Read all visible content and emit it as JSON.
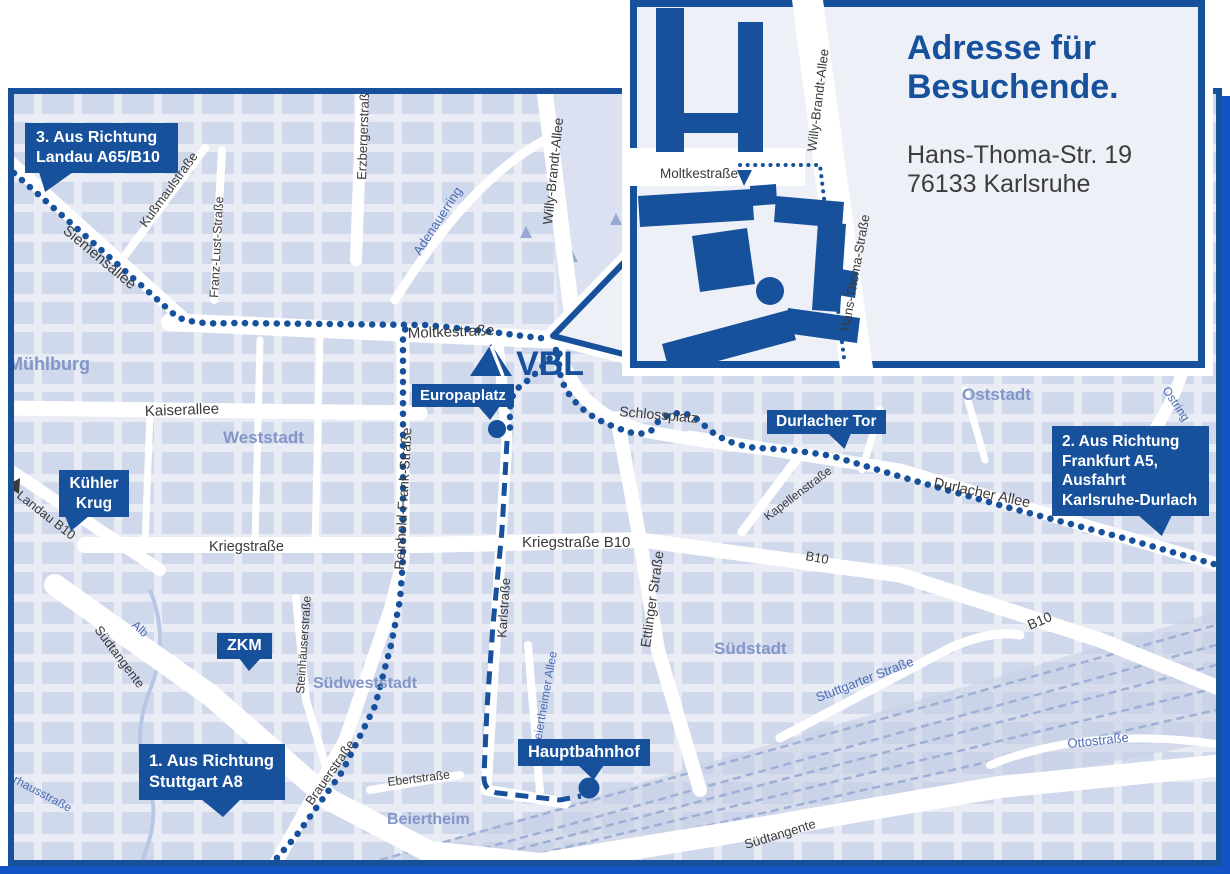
{
  "inset": {
    "title": [
      "Adresse für",
      "Besuchende."
    ],
    "address": [
      "Hans-Thoma-Str. 19",
      "76133 Karlsruhe"
    ],
    "streets": {
      "moltkestrasse": "Moltkestraße",
      "willy_brandt_allee": "Willy-Brandt-Allee",
      "hans_thoma_strasse": "Hans-Thoma-Straße"
    }
  },
  "logo": {
    "text": "VBL"
  },
  "callouts": {
    "route3": {
      "lines": [
        "3. Aus Richtung",
        "Landau A65/B10"
      ]
    },
    "route2": {
      "lines": [
        "2. Aus Richtung",
        "Frankfurt A5,",
        "Ausfahrt",
        "Karlsruhe-Durlach"
      ]
    },
    "route1": {
      "lines": [
        "1. Aus Richtung",
        "Stuttgart A8"
      ]
    },
    "kuehler_krug": {
      "lines": [
        "Kühler",
        "Krug"
      ]
    },
    "zkm": {
      "lines": [
        "ZKM"
      ]
    },
    "europaplatz": {
      "lines": [
        "Europaplatz"
      ]
    },
    "durlacher_tor": {
      "lines": [
        "Durlacher Tor"
      ]
    },
    "hauptbahnhof": {
      "lines": [
        "Hauptbahnhof"
      ]
    }
  },
  "streets": {
    "moltkestrasse": "Moltkestraße",
    "siemensallee": "Siemensallee",
    "kussmaulstrasse": "Kußmaulstraße",
    "franz_lust_strasse": "Franz-Lust-Straße",
    "erzbergerstrasse": "Erzbergerstraße",
    "adenauerring": "Adenauerring",
    "willy_brandt_allee": "Willy-Brandt-Allee",
    "kaiserallee": "Kaiserallee",
    "schlossplatz": "Schlossplatz",
    "durlacher_allee": "Durlacher Allee",
    "kapellenstrasse": "Kapellenstraße",
    "kriegstrasse": "Kriegstraße",
    "kriegstrasse_b10": "Kriegstraße B10",
    "reinhold_frank_strasse": "Reinhold-Frank-Straße",
    "landau_b10": "Landau B10",
    "karlstrasse": "Karlstraße",
    "ettlinger_strasse": "Ettlinger Straße",
    "beiertheimer_allee": "Beiertheimer Allee",
    "steinhaeuserstrasse": "Steinhäuserstraße",
    "brauerstrasse": "Brauerstraße",
    "ebertstrasse": "Ebertstraße",
    "alb": "Alb",
    "suedtangente": "Südtangente",
    "stuttgarter_strasse": "Stuttgarter Straße",
    "ottostrasse": "Ottostraße",
    "pulverhausstrasse": "Pulverhausstraße",
    "ostring": "Ostring",
    "b10": "B10"
  },
  "areas": {
    "muehlburg": "Mühlburg",
    "weststadt": "Weststadt",
    "oststadt": "Oststadt",
    "suedstadt": "Südstadt",
    "suedweststadt": "Südweststadt",
    "beiertheim": "Beiertheim"
  },
  "colors": {
    "primary": "#17519c",
    "shadow": "#1253c5",
    "map_background": "#e9ecf4",
    "city_block": "#ccd5e9",
    "street_text": "#3a3a3a",
    "blue_street_text": "#4a6cb3",
    "area_text": "#8296c8"
  }
}
